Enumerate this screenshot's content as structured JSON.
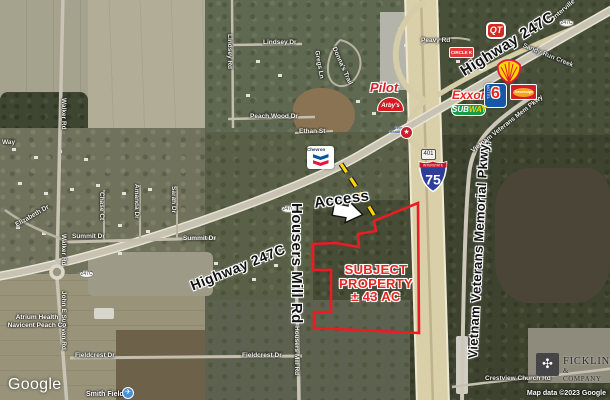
{
  "annotations": {
    "access": "Access",
    "subject": {
      "l1": "SUBJECT",
      "l2": "PROPERTY",
      "l3": "± 43 AC"
    },
    "highway_top": "Highway 247C",
    "highway_lower": "Highway 247C",
    "housers_mill": "Housers Mill Rd",
    "vietnam_pkwy": "Vietnam Veterans Memorial Pkwy,"
  },
  "colors": {
    "property_outline": "#ea1c24",
    "access_dash": "#ffd500"
  },
  "shields": {
    "interstate_word": "INTERSTATE",
    "interstate_num": "75",
    "ga_route": "401",
    "route_oval": "247C"
  },
  "street_labels": [
    "Walker Rd",
    "Walker Rd",
    "Elizabeth Dr",
    "Summit Dr",
    "Summit Dr",
    "Chase Ct",
    "Amanda Dr",
    "Sarah Dr",
    "John E Sullivan Rd",
    "Fieldcrest Dr",
    "Fieldcrest Dr",
    "Lindsey Dr",
    "Lindsey Rd",
    "Peach Wood Dr",
    "Ethan St",
    "Donna's Trail",
    "Gregs Ln",
    "Peavy Rd",
    "Housers Mill Rd",
    "Vietnam Veterans Mem Pkwy",
    "Crestview Church Rd",
    "Sandy Run Creek",
    "Centerville",
    "Way"
  ],
  "poi": {
    "atrium_l1": "Atrium Health",
    "atrium_l2": "Navicent Peach Co",
    "smith_field": "Smith Field",
    "plane_icon": "✈"
  },
  "logos": {
    "qt": "QT",
    "circle_k": "CIRCLE K",
    "pilot": "Pilot",
    "arbys": "Arby's",
    "chevron": "Chevron",
    "exxon": "Exxon",
    "motel6_number": "6",
    "motel6_word": "MOTEL",
    "travelodge": "Travelodge",
    "subway_sub": "SUB",
    "subway_way": "WAY",
    "texas_roadhouse": "Texas Roadhouse",
    "texas_roadhouse_mark": "★"
  },
  "branding": {
    "fickling_mark": "✣",
    "fickling_l1": "FICKLING",
    "fickling_l2": "& COMPANY",
    "google": "Google",
    "attribution": "Map data ©2023 Google"
  }
}
